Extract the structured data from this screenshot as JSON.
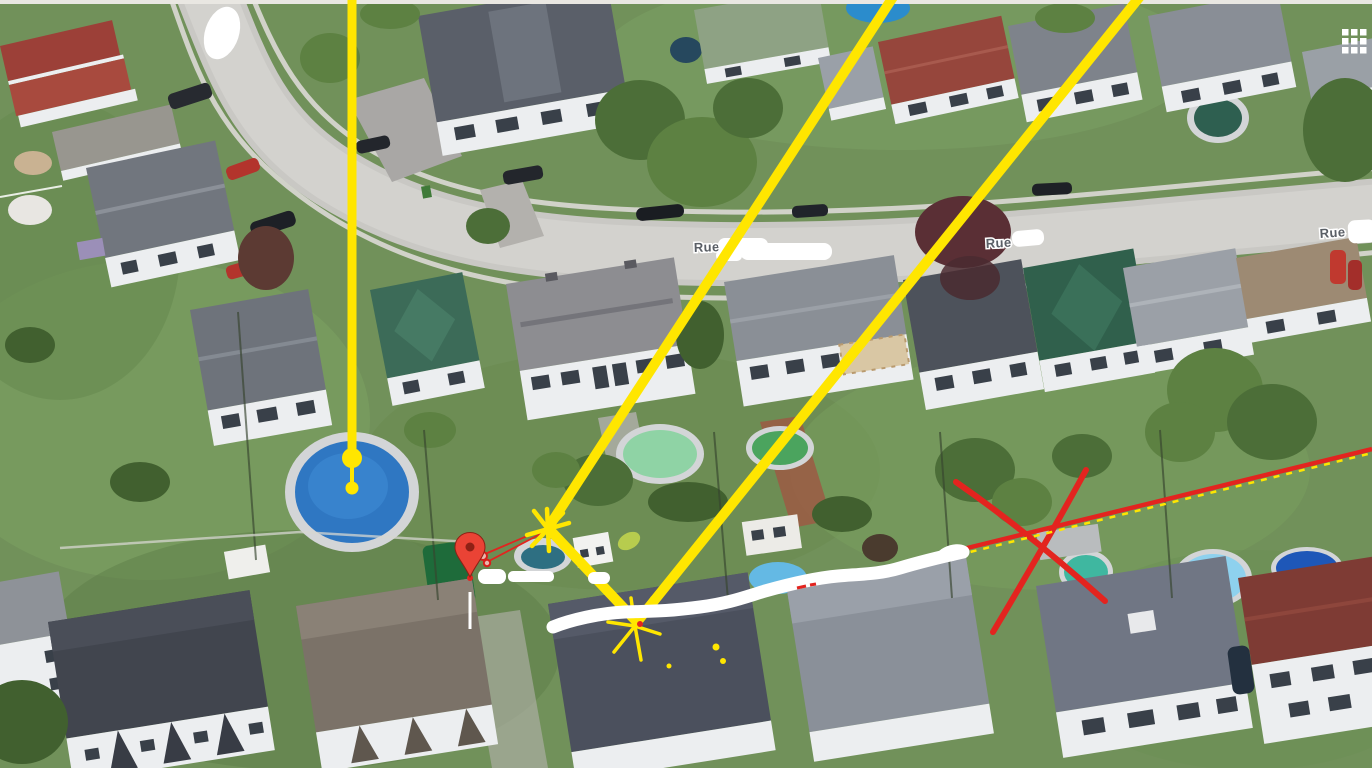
{
  "window": {
    "top_bar_color": "#e9e7e2"
  },
  "map": {
    "kind": "aerial-3d-satellite-view",
    "scene": "residential neighborhood with street, houses and backyard pools",
    "street_labels": [
      {
        "text": "Rue",
        "name_redacted": true
      },
      {
        "text": "Rue",
        "name_redacted": true
      },
      {
        "text": "Rue",
        "name_redacted": true
      }
    ]
  },
  "annotations": {
    "colors": {
      "highlight_yellow": "#ffe600",
      "marker_red": "#e3241f",
      "eraser_white": "#ffffff",
      "pin_red": "#ea4335",
      "label_gray": "#5a5f66"
    },
    "items": [
      {
        "name": "vertical-yellow-line",
        "ends_at": "round blue pool with two yellow dots"
      },
      {
        "name": "yellow-diagonal-line-1",
        "from": "top edge x=895",
        "to": "starburst-1"
      },
      {
        "name": "yellow-diagonal-line-2",
        "from": "top edge x=1142",
        "to": "starburst-2"
      },
      {
        "name": "yellow-connector-line",
        "from": "starburst-1",
        "to": "starburst-2"
      },
      {
        "name": "yellow-starburst-1"
      },
      {
        "name": "yellow-starburst-2",
        "detail": "small red dot at center"
      },
      {
        "name": "red-map-pin",
        "detail": "two small red rings and thin red sight lines to starburst-1, white stem below"
      },
      {
        "name": "white-scribble-redaction",
        "path": "from starburst-2 rising right to red line start"
      },
      {
        "name": "red-line-with-yellow-dashes",
        "from": "x=955",
        "to": "top right corner of lower area"
      },
      {
        "name": "red-x-cross"
      },
      {
        "name": "small-yellow-dots",
        "count": 3
      }
    ]
  },
  "ui": {
    "apps_grid_icon": "3x3-white-grid"
  }
}
